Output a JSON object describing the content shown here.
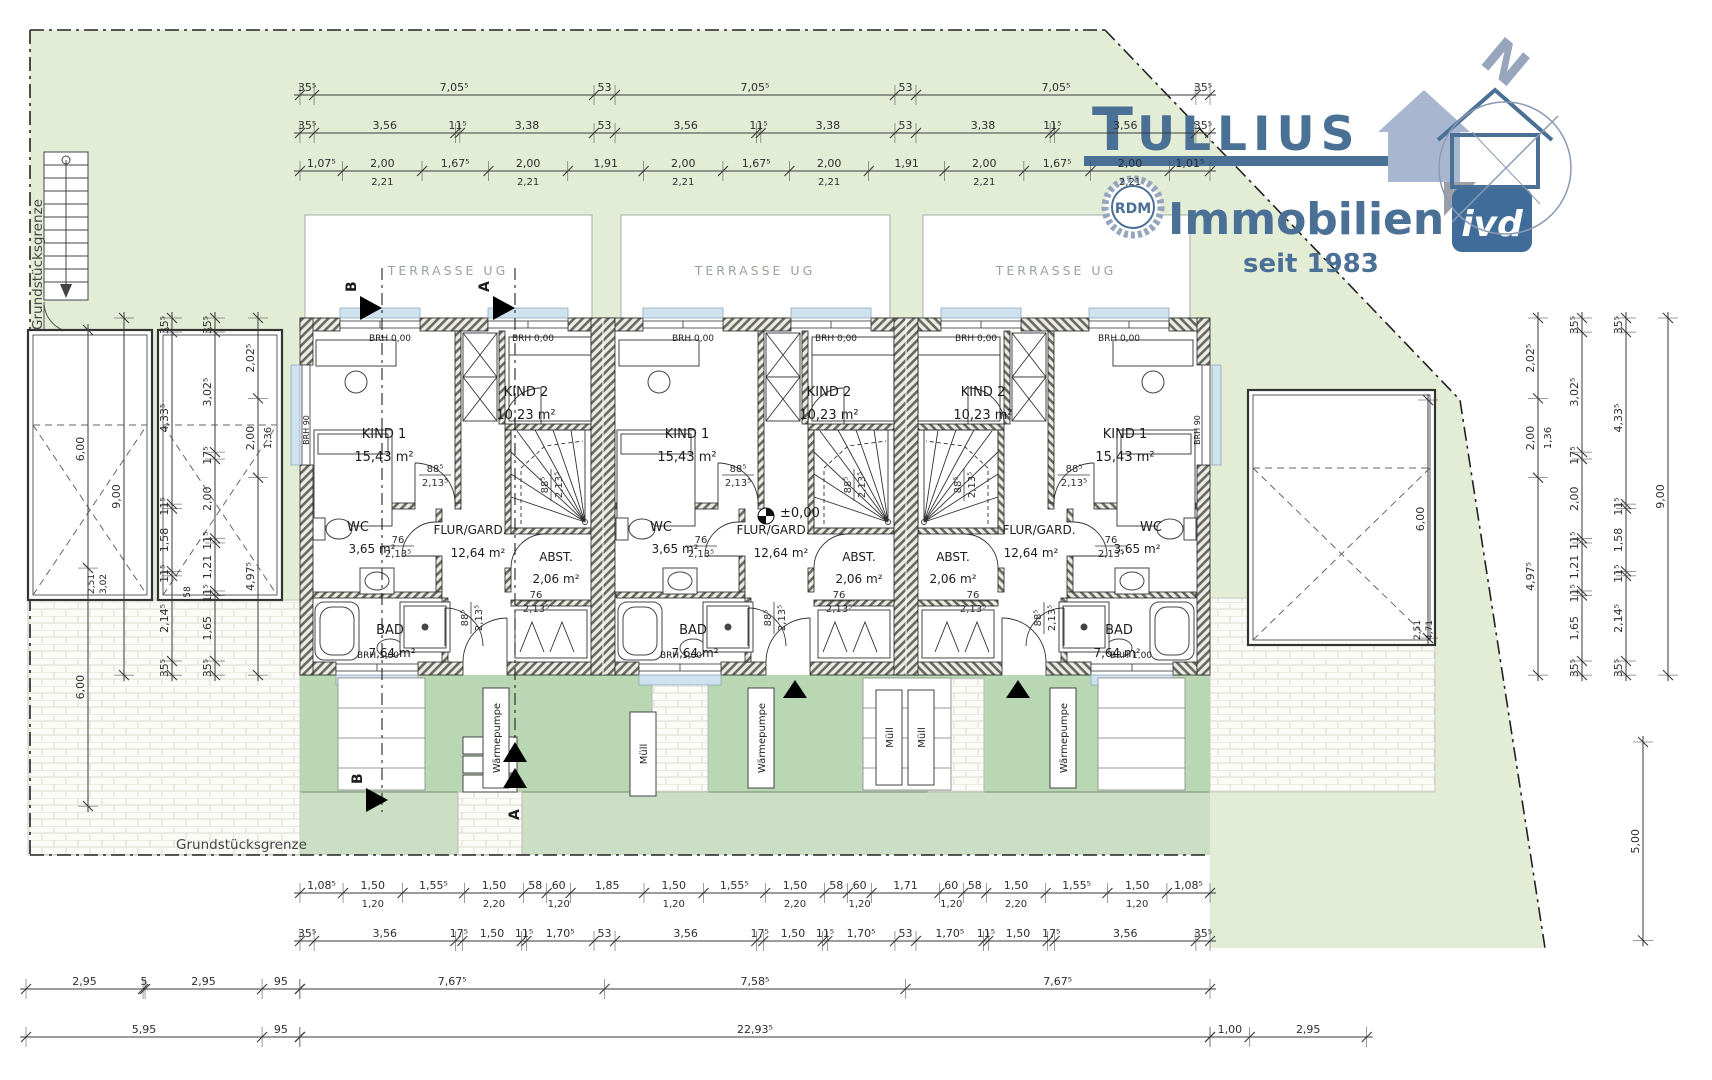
{
  "logo": {
    "brand_initial": "T",
    "brand_rest": "ULLIUS",
    "line2": "Immobilien",
    "since": "seit 1983",
    "rdm": "RDM",
    "ivd": "ivd",
    "north": "N",
    "brand_color": "#4a7095",
    "accent_gray_blue": "#97a6bd"
  },
  "boundary": {
    "left": "Grundstücksgrenze",
    "bottom": "Grundstücksgrenze"
  },
  "terrace_label": "TERRASSE UG",
  "level": {
    "x": 766,
    "y": 516,
    "label": "±0,00"
  },
  "colors": {
    "garden_light": "#e3edd6",
    "garden_rear": "#b9d7b2",
    "garden_rear_low": "#cbdfc4",
    "window_band": "#cfe2f0"
  },
  "plan_labels": [
    [
      384,
      438,
      "KIND 1",
      13
    ],
    [
      384,
      461,
      "15,43 m²",
      13
    ],
    [
      526,
      396,
      "KIND 2",
      13
    ],
    [
      526,
      419,
      "10,23 m²",
      13
    ],
    [
      358,
      531,
      "WC",
      13
    ],
    [
      372,
      553,
      "3,65 m²",
      12
    ],
    [
      470,
      534,
      "FLUR/GARD.",
      12
    ],
    [
      478,
      557,
      "12,64 m²",
      12
    ],
    [
      556,
      561,
      "ABST.",
      12
    ],
    [
      556,
      583,
      "2,06 m²",
      12
    ],
    [
      390,
      634,
      "BAD",
      13
    ],
    [
      392,
      657,
      "7,64 m²",
      12
    ],
    [
      390,
      341,
      "BRH 0,00",
      9
    ],
    [
      533,
      341,
      "BRH 0,00",
      9
    ],
    [
      378,
      658,
      "BRH 1,00",
      9
    ],
    [
      309,
      430,
      "BRH 90",
      8,
      -90
    ],
    [
      687,
      438,
      "KIND 1",
      13
    ],
    [
      687,
      461,
      "15,43 m²",
      13
    ],
    [
      829,
      396,
      "KIND 2",
      13
    ],
    [
      829,
      419,
      "10,23 m²",
      13
    ],
    [
      661,
      531,
      "WC",
      13
    ],
    [
      675,
      553,
      "3,65 m²",
      12
    ],
    [
      773,
      534,
      "FLUR/GARD.",
      12
    ],
    [
      781,
      557,
      "12,64 m²",
      12
    ],
    [
      859,
      561,
      "ABST.",
      12
    ],
    [
      859,
      583,
      "2,06 m²",
      12
    ],
    [
      693,
      634,
      "BAD",
      13
    ],
    [
      695,
      657,
      "7,64 m²",
      12
    ],
    [
      693,
      341,
      "BRH 0,00",
      9
    ],
    [
      836,
      341,
      "BRH 0,00",
      9
    ],
    [
      681,
      658,
      "BRH 1,00",
      9
    ],
    [
      1125,
      438,
      "KIND 1",
      13
    ],
    [
      1125,
      461,
      "15,43 m²",
      13
    ],
    [
      983,
      396,
      "KIND 2",
      13
    ],
    [
      983,
      419,
      "10,23 m²",
      13
    ],
    [
      1151,
      531,
      "WC",
      13
    ],
    [
      1137,
      553,
      "3,65 m²",
      12
    ],
    [
      1039,
      534,
      "FLUR/GARD.",
      12
    ],
    [
      1031,
      557,
      "12,64 m²",
      12
    ],
    [
      953,
      561,
      "ABST.",
      12
    ],
    [
      953,
      583,
      "2,06 m²",
      12
    ],
    [
      1119,
      634,
      "BAD",
      13
    ],
    [
      1117,
      657,
      "7,64 m²",
      12
    ],
    [
      1119,
      341,
      "BRH 0,00",
      9
    ],
    [
      976,
      341,
      "BRH 0,00",
      9
    ],
    [
      1131,
      658,
      "BRH 1,00",
      9
    ],
    [
      1200,
      430,
      "BRH 90",
      8,
      -90
    ],
    [
      94,
      584,
      "2,51",
      9,
      -90
    ],
    [
      106,
      584,
      "3,02",
      9,
      -90
    ],
    [
      190,
      592,
      "58",
      9,
      -90
    ],
    [
      1420,
      630,
      "2,51",
      9,
      -90
    ],
    [
      1432,
      630,
      "4,71",
      9,
      -90
    ]
  ],
  "frac_labels": [
    [
      435,
      472,
      "88⁵",
      "2,13⁵",
      0
    ],
    [
      548,
      485,
      "88⁵",
      "2,13⁵",
      -90
    ],
    [
      398,
      543,
      "76",
      "2,13⁵",
      0
    ],
    [
      536,
      598,
      "76",
      "2,13⁵",
      0
    ],
    [
      468,
      618,
      "88⁵",
      "2,13⁵",
      -90
    ],
    [
      738,
      472,
      "88⁵",
      "2,13⁵",
      0
    ],
    [
      851,
      485,
      "88⁵",
      "2,13⁵",
      -90
    ],
    [
      701,
      543,
      "76",
      "2,13⁵",
      0
    ],
    [
      839,
      598,
      "76",
      "2,13⁵",
      0
    ],
    [
      771,
      618,
      "88⁵",
      "2,13⁵",
      -90
    ],
    [
      1074,
      472,
      "88⁵",
      "2,13⁵",
      0
    ],
    [
      961,
      485,
      "88⁵",
      "2,13⁵",
      -90
    ],
    [
      1111,
      543,
      "76",
      "2,13⁵",
      0
    ],
    [
      973,
      598,
      "76",
      "2,13⁵",
      0
    ],
    [
      1041,
      618,
      "88⁵",
      "2,13⁵",
      -90
    ]
  ],
  "boxes": [
    [
      483,
      688,
      26,
      100,
      "Wärmepumpe"
    ],
    [
      748,
      688,
      26,
      100,
      "Wärmepumpe"
    ],
    [
      1050,
      688,
      26,
      100,
      "Wärmepumpe"
    ],
    [
      630,
      712,
      26,
      84,
      "Müll"
    ],
    [
      876,
      690,
      26,
      95,
      "Müll"
    ],
    [
      908,
      690,
      26,
      95,
      "Müll"
    ]
  ],
  "markers": [
    [
      "flag",
      382,
      308,
      "B"
    ],
    [
      "flag",
      515,
      308,
      "A"
    ],
    [
      "flagr",
      388,
      800,
      "B"
    ],
    [
      "dbl",
      515,
      742,
      "A"
    ],
    [
      "plain",
      795,
      688,
      ""
    ],
    [
      "plain",
      1018,
      688,
      ""
    ]
  ],
  "dims": [
    {
      "o": "h",
      "x": 300,
      "y": 95,
      "segs": [
        [
          0.355,
          "35⁵"
        ],
        [
          7.055,
          "7,05⁵"
        ],
        [
          0.53,
          "53"
        ],
        [
          7.055,
          "7,05⁵"
        ],
        [
          0.53,
          "53"
        ],
        [
          7.055,
          "7,05⁵"
        ],
        [
          0.355,
          "35⁵"
        ]
      ]
    },
    {
      "o": "h",
      "x": 300,
      "y": 133,
      "segs": [
        [
          0.355,
          "35⁵"
        ],
        [
          3.56,
          "3,56"
        ],
        [
          0.115,
          "11⁵"
        ],
        [
          3.38,
          "3,38"
        ],
        [
          0.53,
          "53"
        ],
        [
          3.56,
          "3,56"
        ],
        [
          0.115,
          "11⁵"
        ],
        [
          3.38,
          "3,38"
        ],
        [
          0.53,
          "53"
        ],
        [
          3.38,
          "3,38"
        ],
        [
          0.115,
          "11⁵"
        ],
        [
          3.56,
          "3,56"
        ],
        [
          0.355,
          "35⁵"
        ]
      ]
    },
    {
      "o": "h",
      "x": 300,
      "y": 171,
      "segs": [
        [
          1.075,
          "1,07⁵"
        ],
        [
          2,
          "2,00",
          "2,21"
        ],
        [
          1.675,
          "1,67⁵"
        ],
        [
          2,
          "2,00",
          "2,21"
        ],
        [
          1.91,
          "1,91"
        ],
        [
          2,
          "2,00",
          "2,21"
        ],
        [
          1.675,
          "1,67⁵"
        ],
        [
          2,
          "2,00",
          "2,21"
        ],
        [
          1.91,
          "1,91"
        ],
        [
          2,
          "2,00",
          "2,21"
        ],
        [
          1.675,
          "1,67⁵"
        ],
        [
          2,
          "2,00",
          "2,21"
        ],
        [
          1.015,
          "1,01⁵"
        ]
      ]
    },
    {
      "o": "h",
      "x": 300,
      "y": 893,
      "segs": [
        [
          1.085,
          "1,08⁵"
        ],
        [
          1.5,
          "1,50",
          "1,20"
        ],
        [
          1.555,
          "1,55⁵"
        ],
        [
          1.5,
          "1,50",
          "2,20"
        ],
        [
          0.58,
          "58"
        ],
        [
          0.6,
          "60",
          "1,20"
        ],
        [
          1.85,
          "1,85"
        ],
        [
          1.5,
          "1,50",
          "1,20"
        ],
        [
          1.555,
          "1,55⁵"
        ],
        [
          1.5,
          "1,50",
          "2,20"
        ],
        [
          0.58,
          "58"
        ],
        [
          0.6,
          "60",
          "1,20"
        ],
        [
          1.71,
          "1,71"
        ],
        [
          0.6,
          "60",
          "1,20"
        ],
        [
          0.58,
          "58"
        ],
        [
          1.5,
          "1,50",
          "2,20"
        ],
        [
          1.555,
          "1,55⁵"
        ],
        [
          1.5,
          "1,50",
          "1,20"
        ],
        [
          1.085,
          "1,08⁵"
        ]
      ]
    },
    {
      "o": "h",
      "x": 300,
      "y": 941,
      "segs": [
        [
          0.355,
          "35⁵"
        ],
        [
          3.56,
          "3,56"
        ],
        [
          0.175,
          "17⁵"
        ],
        [
          1.5,
          "1,50"
        ],
        [
          0.115,
          "11⁵"
        ],
        [
          1.705,
          "1,70⁵"
        ],
        [
          0.53,
          "53"
        ],
        [
          3.56,
          "3,56"
        ],
        [
          0.175,
          "17⁵"
        ],
        [
          1.5,
          "1,50"
        ],
        [
          0.115,
          "11⁵"
        ],
        [
          1.705,
          "1,70⁵"
        ],
        [
          0.53,
          "53"
        ],
        [
          1.705,
          "1,70⁵"
        ],
        [
          0.115,
          "11⁵"
        ],
        [
          1.5,
          "1,50"
        ],
        [
          0.175,
          "17⁵"
        ],
        [
          3.56,
          "3,56"
        ],
        [
          0.355,
          "35⁵"
        ]
      ]
    },
    {
      "o": "h",
      "x": 26,
      "y": 989,
      "segs": [
        [
          2.95,
          "2,95"
        ],
        [
          0.05,
          "5"
        ],
        [
          2.95,
          "2,95"
        ],
        [
          0.95,
          "95"
        ]
      ]
    },
    {
      "o": "h",
      "x": 300,
      "y": 989,
      "segs": [
        [
          7.675,
          "7,67⁵"
        ],
        [
          7.585,
          "7,58⁵"
        ],
        [
          7.675,
          "7,67⁵"
        ]
      ]
    },
    {
      "o": "h",
      "x": 26,
      "y": 1037,
      "segs": [
        [
          5.95,
          "5,95"
        ],
        [
          0.95,
          "95"
        ]
      ]
    },
    {
      "o": "h",
      "x": 300,
      "y": 1037,
      "segs": [
        [
          22.935,
          "22,93⁵"
        ]
      ]
    },
    {
      "o": "h",
      "x": 1210,
      "y": 1037,
      "segs": [
        [
          1.0,
          "1,00"
        ],
        [
          2.95,
          "2,95"
        ]
      ]
    },
    {
      "o": "v",
      "x": 88,
      "y": 330,
      "segs": [
        [
          6,
          "6,00"
        ],
        [
          6,
          "6,00"
        ]
      ]
    },
    {
      "o": "v",
      "x": 124,
      "y": 318,
      "segs": [
        [
          9,
          "9,00"
        ]
      ]
    },
    {
      "o": "v",
      "x": 172,
      "y": 318,
      "segs": [
        [
          0.355,
          "35⁵"
        ],
        [
          4.335,
          "4,33⁵"
        ],
        [
          0.115,
          "11⁵"
        ],
        [
          1.58,
          "1,58"
        ],
        [
          0.115,
          "11⁵"
        ],
        [
          2.145,
          "2,14⁵"
        ],
        [
          0.355,
          "35⁵"
        ]
      ]
    },
    {
      "o": "v",
      "x": 215,
      "y": 318,
      "segs": [
        [
          0.355,
          "35⁵"
        ],
        [
          3.025,
          "3,02⁵"
        ],
        [
          0.175,
          "17⁵"
        ],
        [
          2,
          "2,00"
        ],
        [
          0.115,
          "11⁵"
        ],
        [
          1.21,
          "1,21"
        ],
        [
          0.115,
          "11⁵"
        ],
        [
          1.65,
          "1,65"
        ],
        [
          0.355,
          "35⁵"
        ]
      ]
    },
    {
      "o": "v",
      "x": 258,
      "y": 318,
      "segs": [
        [
          2.025,
          "2,02⁵"
        ],
        [
          2,
          "2,00",
          "1,36"
        ],
        [
          4.975,
          "4,97⁵"
        ]
      ]
    },
    {
      "o": "v",
      "x": 1428,
      "y": 400,
      "segs": [
        [
          6,
          "6,00"
        ]
      ]
    },
    {
      "o": "v",
      "x": 1538,
      "y": 318,
      "segs": [
        [
          2.025,
          "2,02⁵"
        ],
        [
          2,
          "2,00",
          "1,36"
        ],
        [
          4.975,
          "4,97⁵"
        ]
      ]
    },
    {
      "o": "v",
      "x": 1582,
      "y": 318,
      "segs": [
        [
          0.355,
          "35⁵"
        ],
        [
          3.025,
          "3,02⁵"
        ],
        [
          0.175,
          "17⁵"
        ],
        [
          2,
          "2,00"
        ],
        [
          0.115,
          "11⁵"
        ],
        [
          1.21,
          "1,21"
        ],
        [
          0.115,
          "11⁵"
        ],
        [
          1.65,
          "1,65"
        ],
        [
          0.355,
          "35⁵"
        ]
      ]
    },
    {
      "o": "v",
      "x": 1626,
      "y": 318,
      "segs": [
        [
          0.355,
          "35⁵"
        ],
        [
          4.335,
          "4,33⁵"
        ],
        [
          0.115,
          "11⁵"
        ],
        [
          1.58,
          "1,58"
        ],
        [
          0.115,
          "11⁵"
        ],
        [
          2.145,
          "2,14⁵"
        ],
        [
          0.355,
          "35⁵"
        ]
      ]
    },
    {
      "o": "v",
      "x": 1668,
      "y": 318,
      "segs": [
        [
          9,
          "9,00"
        ]
      ]
    },
    {
      "o": "v",
      "x": 1643,
      "y": 742,
      "segs": [
        [
          5,
          "5,00"
        ]
      ]
    }
  ]
}
